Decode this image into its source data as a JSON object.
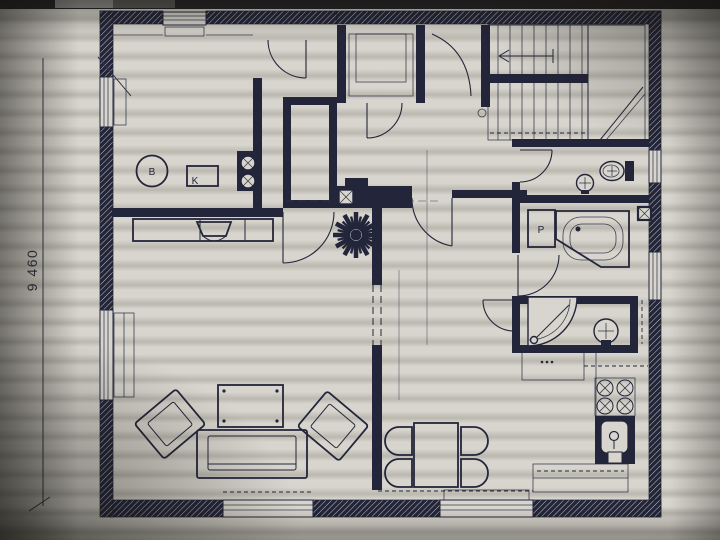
{
  "colors": {
    "ink": "#23253a",
    "paper": "#d7d5cd",
    "paper-dark": "#bab8af",
    "topbar": "#232224",
    "tab1": "#8f8d8a",
    "tab2": "#595755"
  },
  "plan": {
    "dimension": {
      "value": "9 460",
      "orientation": "vertical"
    },
    "labels": {
      "boiler_circle": "B",
      "boiler_box": "K",
      "washing_machine": "P"
    },
    "fixtures": [
      "staircase",
      "up-arrow",
      "toilet",
      "wc-washbasin",
      "corner-bathtub",
      "washing-machine",
      "vent-grille",
      "shower-cabin",
      "shower-washbasin",
      "fireplace-stove",
      "chimney-flue",
      "kitchen-stove",
      "kitchen-sink",
      "kitchen-counter",
      "dining-table",
      "dining-chair",
      "sofa",
      "armchair",
      "coffee-table",
      "tv-cabinet",
      "boiler",
      "closet"
    ]
  }
}
